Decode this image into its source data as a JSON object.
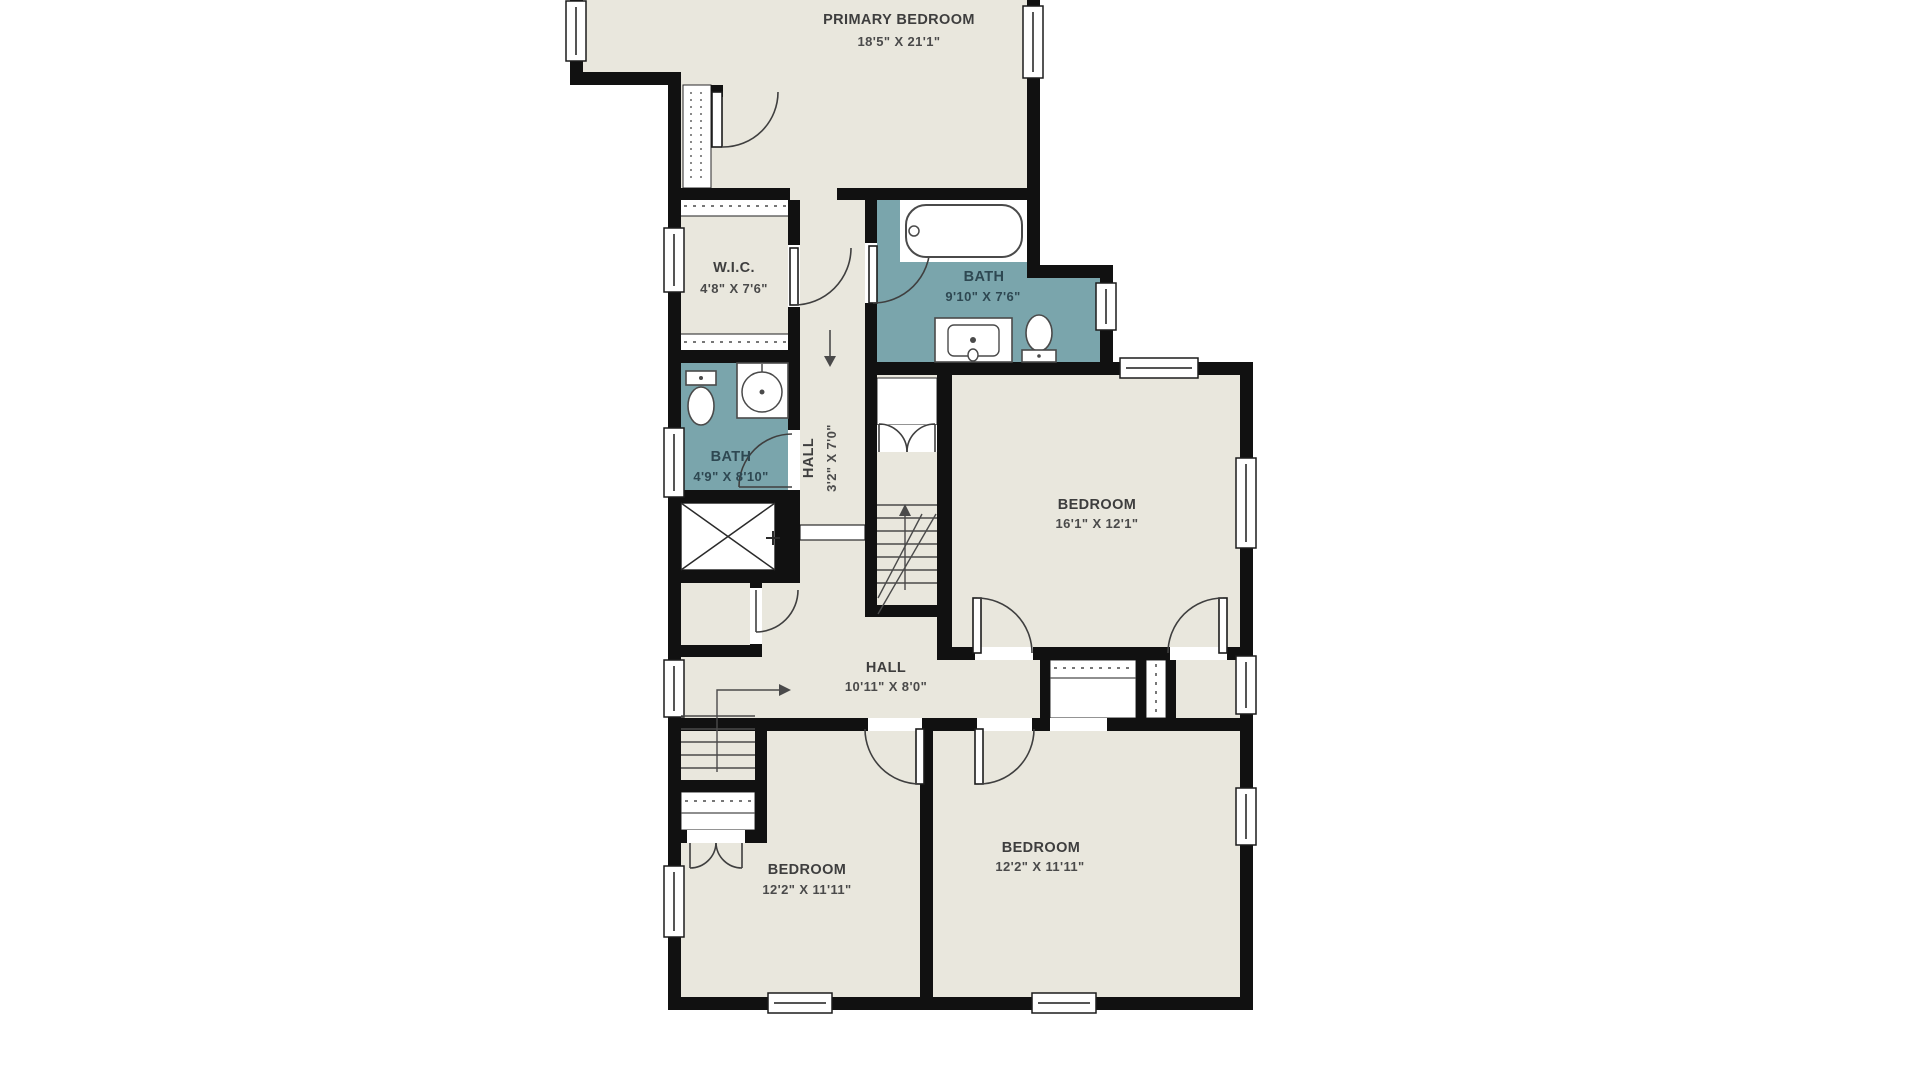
{
  "plan": {
    "type": "floor-plan",
    "rooms": {
      "primary_bedroom": {
        "name": "PRIMARY BEDROOM",
        "dims": "18'5\" X 21'1\""
      },
      "wic": {
        "name": "W.I.C.",
        "dims": "4'8\" X 7'6\""
      },
      "primary_bath": {
        "name": "BATH",
        "dims": "9'10\" X 7'6\""
      },
      "upper_hall": {
        "name": "HALL",
        "dims": "3'2\" X 7'0\""
      },
      "hall_bath": {
        "name": "BATH",
        "dims": "4'9\" X 8'10\""
      },
      "bedroom_east": {
        "name": "BEDROOM",
        "dims": "16'1\" X 12'1\""
      },
      "main_hall": {
        "name": "HALL",
        "dims": "10'11\" X 8'0\""
      },
      "bedroom_southwest": {
        "name": "BEDROOM",
        "dims": "12'2\" X 11'11\""
      },
      "bedroom_southeast": {
        "name": "BEDROOM",
        "dims": "12'2\" X 11'11\""
      }
    },
    "colors": {
      "floor": "#e9e7dd",
      "bath_floor": "#7aa5ac",
      "walls": "#111111",
      "background": "#ffffff",
      "fixture_line": "#4a4a4a"
    }
  }
}
